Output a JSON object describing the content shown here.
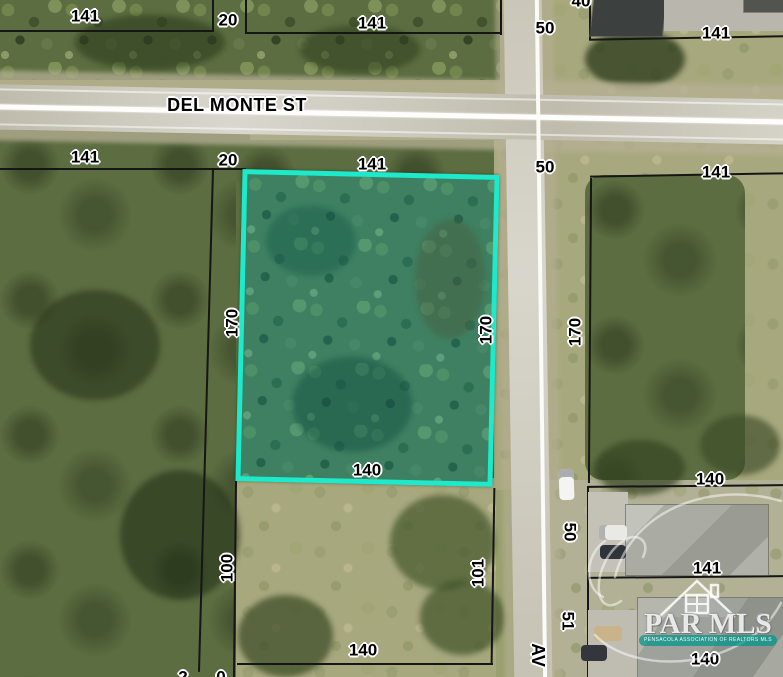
{
  "map": {
    "street_horizontal": "DEL MONTE ST",
    "street_vertical": "AV",
    "highlight_color": "#1de9cb",
    "boundary_color": "#161616",
    "label_halo_color": "#ffffff",
    "dimension_labels": [
      {
        "text": "141",
        "x": 85,
        "y": 16,
        "rot": 0
      },
      {
        "text": "20",
        "x": 228,
        "y": 20,
        "rot": 0
      },
      {
        "text": "141",
        "x": 372,
        "y": 23,
        "rot": 0
      },
      {
        "text": "40",
        "x": 581,
        "y": 1,
        "rot": 0
      },
      {
        "text": "50",
        "x": 545,
        "y": 28,
        "rot": 0
      },
      {
        "text": "141",
        "x": 716,
        "y": 33,
        "rot": 0
      },
      {
        "text": "141",
        "x": 85,
        "y": 157,
        "rot": 0
      },
      {
        "text": "20",
        "x": 228,
        "y": 160,
        "rot": 0
      },
      {
        "text": "141",
        "x": 372,
        "y": 164,
        "rot": 0
      },
      {
        "text": "50",
        "x": 545,
        "y": 167,
        "rot": 0
      },
      {
        "text": "141",
        "x": 716,
        "y": 172,
        "rot": 0
      },
      {
        "text": "170",
        "x": 232,
        "y": 323,
        "rot": -90
      },
      {
        "text": "170",
        "x": 486,
        "y": 330,
        "rot": -90
      },
      {
        "text": "170",
        "x": 575,
        "y": 332,
        "rot": -90
      },
      {
        "text": "140",
        "x": 367,
        "y": 470,
        "rot": 0
      },
      {
        "text": "100",
        "x": 227,
        "y": 568,
        "rot": -90
      },
      {
        "text": "101",
        "x": 478,
        "y": 573,
        "rot": -90
      },
      {
        "text": "50",
        "x": 570,
        "y": 532,
        "rot": 90
      },
      {
        "text": "51",
        "x": 568,
        "y": 621,
        "rot": 90
      },
      {
        "text": "140",
        "x": 710,
        "y": 479,
        "rot": 0
      },
      {
        "text": "141",
        "x": 707,
        "y": 568,
        "rot": 0
      },
      {
        "text": "140",
        "x": 705,
        "y": 659,
        "rot": 0
      },
      {
        "text": "140",
        "x": 363,
        "y": 650,
        "rot": 0
      },
      {
        "text": "2",
        "x": 183,
        "y": 677,
        "rot": 0
      },
      {
        "text": "0",
        "x": 221,
        "y": 677,
        "rot": 0
      }
    ],
    "watermark": {
      "title": "PAR MLS",
      "subtitle": "PENSACOLA ASSOCIATION OF REALTORS MLS"
    }
  }
}
